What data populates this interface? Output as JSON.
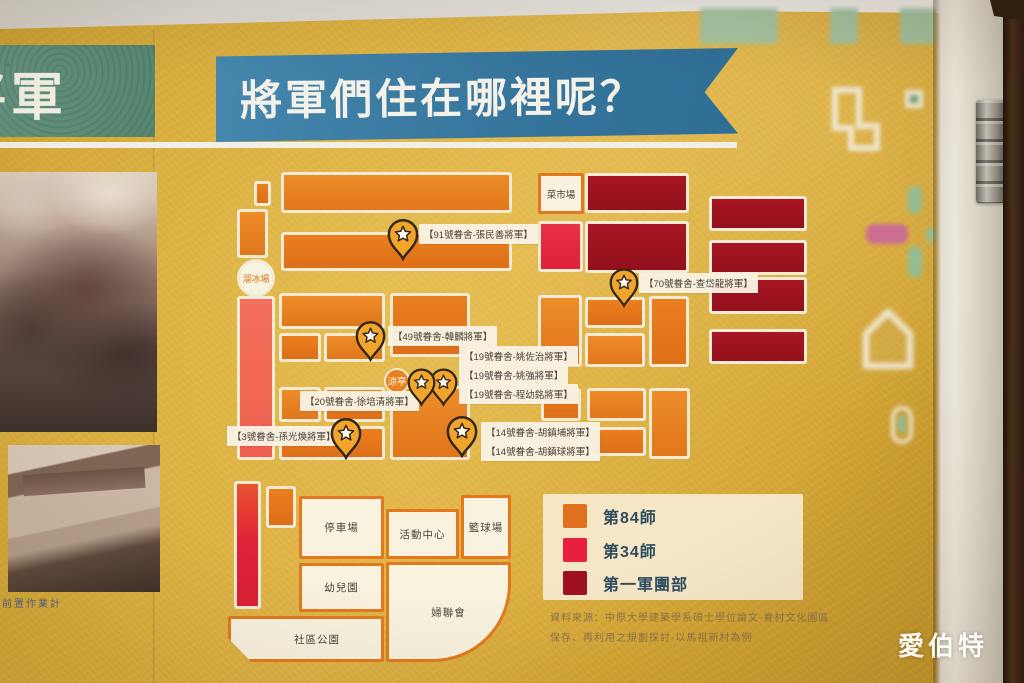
{
  "poster": {
    "title": "將軍們住在哪裡呢？",
    "left_panel_title": "將軍",
    "left_caption": "前置作業計",
    "ribbon_color": "#35749B",
    "board_color": "#D9AC3A"
  },
  "map": {
    "market": "菜市場",
    "skating_rink": "溜冰場",
    "pavilion": "涼亭",
    "general_homes": [
      "【91號眷舍-張民善將軍】",
      "【70號眷舍-查岱龍將軍】",
      "【49號眷舍-韓麟將軍】",
      "【19號眷舍-姚佐治將軍】",
      "【19號眷舍-姚強將軍】",
      "【19號眷舍-程幼銘將軍】",
      "【20號眷舍-徐培清將軍】",
      "【3號眷舍-孫光煥將軍】",
      "【14號眷舍-胡鎮埔將軍】",
      "【14號眷舍-胡鎮球將軍】"
    ],
    "facilities": {
      "parking": "停車場",
      "activity_center": "活動中心",
      "basketball": "籃球場",
      "kindergarten": "幼兒園",
      "womens_league": "婦聯會",
      "community_park": "社區公園"
    }
  },
  "legend": {
    "items": [
      {
        "label": "第84師",
        "color": "#E0701E"
      },
      {
        "label": "第34師",
        "color": "#E6203E"
      },
      {
        "label": "第一軍團部",
        "color": "#9E1120"
      }
    ]
  },
  "source": {
    "line1": "資料來源：中原大學建築學系碩士學位論文-眷村文化園區",
    "line2": "保存、再利用之規劃探討-以馬祖新村為例"
  },
  "watermark": "愛伯特"
}
